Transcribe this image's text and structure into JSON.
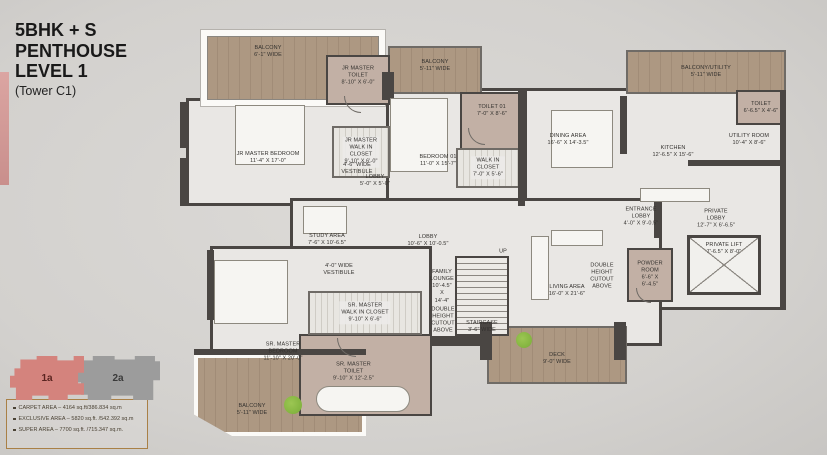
{
  "title": {
    "line1": "5BHK + S",
    "line2": "PENTHOUSE",
    "line3": "LEVEL 1",
    "tower": "(Tower C1)"
  },
  "colors": {
    "background": "#d6d4d1",
    "room": "#e9e7e4",
    "wood": "#ad9882",
    "wood_dark": "#a18c77",
    "toilet": "#c2b0a5",
    "wall": "#4a4643",
    "accent_unit1": "#d4837d",
    "accent_unit2": "#9c9c9c",
    "legend_border": "#a98046",
    "text": "#33312e",
    "plant": "#83b43f"
  },
  "legend": {
    "unit1_label": "1a",
    "unit2_label": "2a",
    "areas": [
      "CARPET AREA – 4164 sq.ft/386.834 sq.m",
      "EXCLUSIVE AREA – 5820 sq.ft. /542.392 sq.m",
      "SUPER AREA – 7700 sq.ft. /715.347 sq.m."
    ]
  },
  "plan": {
    "areas": [
      {
        "name": "jr-master-wing",
        "type": "room",
        "x": 186,
        "y": 98,
        "w": 206,
        "h": 108
      },
      {
        "name": "bedroom-01-block",
        "type": "room",
        "x": 386,
        "y": 88,
        "w": 139,
        "h": 118
      },
      {
        "name": "great-room-block",
        "type": "room",
        "x": 524,
        "y": 88,
        "w": 262,
        "h": 222
      },
      {
        "name": "central-block",
        "type": "room",
        "x": 290,
        "y": 198,
        "w": 372,
        "h": 148
      },
      {
        "name": "sr-master-wing",
        "type": "room",
        "x": 210,
        "y": 246,
        "w": 222,
        "h": 166
      },
      {
        "name": "balcony-top-left",
        "type": "wood-framed",
        "x": 201,
        "y": 30,
        "w": 184,
        "h": 76,
        "label": "BALCONY\n6'-1\" WIDE",
        "dx": -25,
        "dy": -16
      },
      {
        "name": "balcony-top-middle",
        "type": "wood",
        "x": 388,
        "y": 46,
        "w": 94,
        "h": 48,
        "label": "BALCONY\n5'-11\" WIDE",
        "dy": -4
      },
      {
        "name": "balcony-utility-top-right",
        "type": "wood",
        "x": 626,
        "y": 50,
        "w": 160,
        "h": 44,
        "label": "BALCONY/UTILITY\n5'-11\" WIDE"
      },
      {
        "name": "balcony-bottom-left",
        "type": "wood",
        "x": 194,
        "y": 354,
        "w": 172,
        "h": 82,
        "label": "BALCONY\n5'-11\" WIDE",
        "dx": -28,
        "dy": 15
      },
      {
        "name": "deck",
        "type": "wood",
        "x": 487,
        "y": 326,
        "w": 140,
        "h": 58,
        "label": "DECK\n9'-0\" WIDE",
        "dy": 4
      },
      {
        "name": "jr-master-toilet",
        "type": "toilet",
        "x": 326,
        "y": 55,
        "w": 64,
        "h": 50,
        "label": "JR MASTER\nTOILET\n8'-10\" X 6'-0\"",
        "dy": -4
      },
      {
        "name": "toilet-01",
        "type": "toilet",
        "x": 460,
        "y": 92,
        "w": 64,
        "h": 58,
        "label": "TOILET 01\n7'-0\" X 8'-6\"",
        "dy": -10
      },
      {
        "name": "toilet-top-right",
        "type": "toilet",
        "x": 736,
        "y": 90,
        "w": 50,
        "h": 35,
        "label": "TOILET\n6'-6.5\" X 4'-6\""
      },
      {
        "name": "powder-room",
        "type": "toilet",
        "x": 627,
        "y": 248,
        "w": 46,
        "h": 54,
        "label": "POWDER\nROOM\n6'-6\" X\n6'-4.5\""
      },
      {
        "name": "sr-master-toilet",
        "type": "toilet",
        "x": 299,
        "y": 334,
        "w": 133,
        "h": 82,
        "label": "SR. MASTER\nTOILET\n9'-10\" X 12'-2.5\"",
        "dx": -12,
        "dy": -3
      },
      {
        "name": "jr-master-closet",
        "type": "closet",
        "x": 332,
        "y": 126,
        "w": 58,
        "h": 52,
        "label": "JR MASTER\nWALK IN\nCLOSET\n9'-10\" X 6'-0\""
      },
      {
        "name": "walkin-closet-01",
        "type": "closet",
        "x": 456,
        "y": 148,
        "w": 64,
        "h": 40,
        "label": "WALK IN\nCLOSET\n7'-0\" X 5'-6\""
      },
      {
        "name": "sr-master-closet",
        "type": "closet",
        "x": 308,
        "y": 291,
        "w": 114,
        "h": 44,
        "label": "SR. MASTER\nWALK IN CLOSET\n9'-10\" X 6'-6\""
      },
      {
        "name": "staircase",
        "type": "stairs",
        "x": 455,
        "y": 256,
        "w": 54,
        "h": 80,
        "label": "STAIRCASE\n3'-6\" WIDE",
        "dy": 31
      },
      {
        "name": "private-lift",
        "type": "lift",
        "x": 687,
        "y": 235,
        "w": 74,
        "h": 60,
        "label": "PRIVATE LIFT\n7'-6.5\" X 8'-0\"",
        "dy": -16
      },
      {
        "name": "jr-master-bedroom",
        "type": "label",
        "x": 268,
        "y": 158,
        "label": "JR MASTER BEDROOM\n11'-4\" X 17'-0\""
      },
      {
        "name": "vestibule-jr",
        "type": "label",
        "x": 357,
        "y": 169,
        "label": "4'-6\" WIDE\nVESTIBULE"
      },
      {
        "name": "lobby-small",
        "type": "label",
        "x": 375,
        "y": 181,
        "label": "LOBBY\n5'-0\" X 5'-0\""
      },
      {
        "name": "bedroom-01",
        "type": "label",
        "x": 438,
        "y": 161,
        "label": "BEDROOM 01\n11'-0\" X 15'-7\""
      },
      {
        "name": "dining-area",
        "type": "label",
        "x": 568,
        "y": 140,
        "label": "DINING AREA\n16'-6\" X 14'-3.5\""
      },
      {
        "name": "kitchen",
        "type": "label",
        "x": 673,
        "y": 152,
        "label": "KITCHEN\n12'-6.5\" X 15'-6\""
      },
      {
        "name": "utility-room",
        "type": "label",
        "x": 749,
        "y": 140,
        "label": "UTILITY ROOM\n10'-4\" X 8'-6\""
      },
      {
        "name": "entrance-lobby",
        "type": "label",
        "x": 641,
        "y": 217,
        "label": "ENTRANCE\nLOBBY\n4'-0\" X 9'-0.5\""
      },
      {
        "name": "private-lobby",
        "type": "label",
        "x": 716,
        "y": 219,
        "label": "PRIVATE\nLOBBY\n12'-7\" X 6'-6.5\""
      },
      {
        "name": "study-area",
        "type": "label",
        "x": 327,
        "y": 240,
        "label": "STUDY AREA\n7'-6\" X 10'-6.5\""
      },
      {
        "name": "lobby-main",
        "type": "label",
        "x": 428,
        "y": 241,
        "label": "LOBBY\n10'-6\" X 10'-0.5\""
      },
      {
        "name": "vestibule-sr",
        "type": "label",
        "x": 339,
        "y": 270,
        "label": "4'-0\" WIDE\nVESTIBULE"
      },
      {
        "name": "family-lounge",
        "type": "label",
        "x": 442,
        "y": 287,
        "label": "FAMILY\nLOUNGE\n10'-4.5\"\nX\n14'-4\""
      },
      {
        "name": "double-height-cutout-left",
        "type": "label",
        "x": 443,
        "y": 321,
        "label": "DOUBLE\nHEIGHT\nCUTOUT\nABOVE"
      },
      {
        "name": "living-area",
        "type": "label",
        "x": 567,
        "y": 291,
        "label": "LIVING AREA\n16'-0\" X 21'-6\""
      },
      {
        "name": "double-height-cutout-right",
        "type": "label",
        "x": 602,
        "y": 277,
        "label": "DOUBLE\nHEIGHT\nCUTOUT\nABOVE"
      },
      {
        "name": "sr-master-bedroom",
        "type": "label",
        "x": 283,
        "y": 352,
        "label": "SR. MASTER\nBEDROOM\n11'-10\" X 20'-0\""
      },
      {
        "name": "up",
        "type": "label",
        "x": 503,
        "y": 252,
        "label": "UP"
      }
    ]
  }
}
